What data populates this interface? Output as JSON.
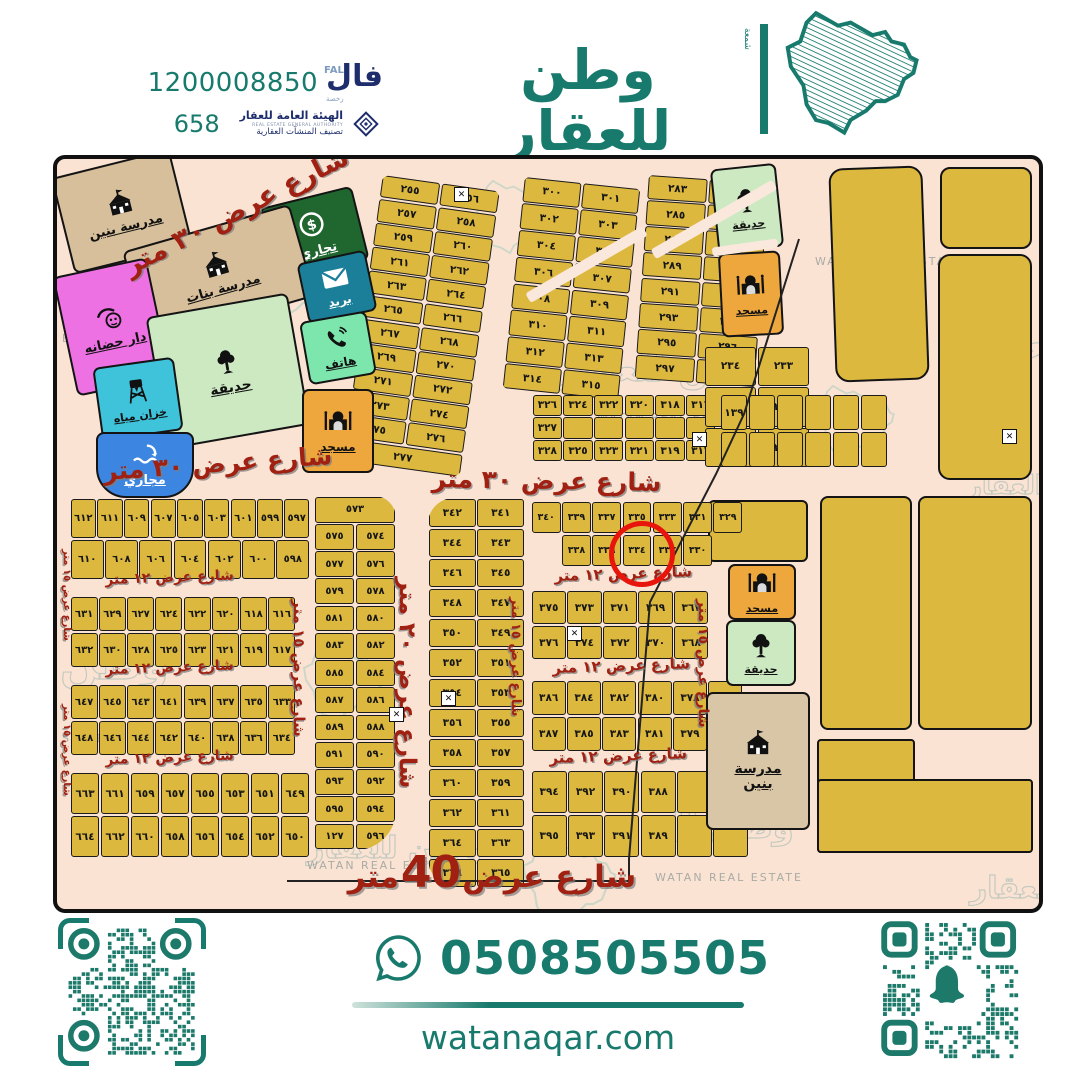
{
  "header": {
    "phone": "1200008850",
    "license": "658",
    "fal": {
      "ar": "فال",
      "en": "FAL",
      "sub": "رخصة"
    },
    "authority": {
      "name": "الهيئة العامة للعقار",
      "sub_en": "REAL ESTATE GENERAL AUTHORITY",
      "sub": "تصنيف المنشآت العقارية"
    },
    "brand": {
      "ar": "وطن للعقار",
      "en": "WATAN REAL ESTATE",
      "side": "شمعة"
    }
  },
  "footer": {
    "whatsapp": "0508505505",
    "website": "watanaqar.com"
  },
  "map": {
    "highlight": {
      "plot": "٣٣٤",
      "plot_latin": "334"
    },
    "facilities": {
      "school_boys": {
        "label": "مدرسة بنين"
      },
      "school_girls": {
        "label": "مدرسة بنات"
      },
      "commercial": {
        "label": "تجاري"
      },
      "post": {
        "label": "بريد"
      },
      "telephone": {
        "label": "هاتف"
      },
      "nursery": {
        "label": "دار حضانه"
      },
      "garden": {
        "label": "حديقة"
      },
      "water_tank": {
        "label": "خزان مياه"
      },
      "sewage": {
        "label": "مجاري"
      },
      "mosque": {
        "label": "مسجد"
      }
    },
    "street_labels": [
      {
        "text": "شارع عرض ٣٠ متر"
      },
      {
        "text": "شارع عرض ٣٠ متر"
      },
      {
        "text": "شارع عرض ٣٠ متر"
      },
      {
        "text": "شارع عرض ١٢ متر"
      },
      {
        "text": "شارع عرض ١٢ متر"
      },
      {
        "text": "شارع عرض ١٢ متر"
      },
      {
        "text": "شارع عرض ١٢ متر"
      },
      {
        "text": "شارع عرض ١٢ متر"
      },
      {
        "text": "شارع عرض ١٢ متر"
      },
      {
        "text": "شارع عرض ١٥ متر"
      },
      {
        "text": "شارع عرض ٢٠ متر"
      },
      {
        "text": "شارع عرض ١٥ متر"
      },
      {
        "text": "شارع عرض ١٥ متر"
      },
      {
        "text": "شارع عرض ١٥ متر"
      },
      {
        "text": "شارع عرض ١٥ متر"
      }
    ],
    "bottom_street": {
      "pre": "شارع عرض",
      "num": "40",
      "post": "متر"
    },
    "watermarks": [
      {
        "text": "وطن"
      },
      {
        "text": "طن للعقار"
      },
      {
        "text": "للعقار"
      },
      {
        "text": "العقار"
      },
      {
        "text": "وطن"
      },
      {
        "text": "لعقار"
      },
      {
        "text": "وطن لل"
      },
      {
        "text": "وطن للعقار"
      }
    ],
    "watermarks_en": [
      {
        "text": "WATAN REAL ESTATE"
      },
      {
        "text": "WATAN REAL ESTATE"
      },
      {
        "text": "ESTATE"
      },
      {
        "text": "STATE"
      },
      {
        "text": "WATAN REAL ESTATE"
      },
      {
        "text": "WATAN REAL ESTATE"
      }
    ],
    "blocks": [
      {
        "name": "b255",
        "rows": [
          [
            "٢٥٥",
            "٢٥٦"
          ],
          [
            "٢٥٧",
            "٢٥٨"
          ],
          [
            "٢٥٩",
            "٢٦٠"
          ],
          [
            "٢٦١",
            "٢٦٢"
          ],
          [
            "٢٦٣",
            "٢٦٤"
          ],
          [
            "٢٦٥",
            "٢٦٦"
          ],
          [
            "٢٦٧",
            "٢٦٨"
          ],
          [
            "٢٦٩",
            "٢٧٠"
          ],
          [
            "٢٧١",
            "٢٧٢"
          ],
          [
            "٢٧٣",
            "٢٧٤"
          ],
          [
            "٢٧٥",
            "٢٧٦"
          ],
          [
            "٢٧٧"
          ]
        ]
      },
      {
        "name": "b300",
        "rows": [
          [
            "٣٠٠",
            "٣٠١"
          ],
          [
            "٣٠٢",
            "٣٠٣"
          ],
          [
            "٣٠٤",
            "٣٠٥"
          ],
          [
            "٣٠٦",
            "٣٠٧"
          ],
          [
            "٣٠٨",
            "٣٠٩"
          ],
          [
            "٣١٠",
            "٣١١"
          ],
          [
            "٣١٢",
            "٣١٣"
          ],
          [
            "٣١٤",
            "٣١٥"
          ]
        ]
      },
      {
        "name": "b283",
        "rows": [
          [
            "٢٨٣",
            "٢٨٤"
          ],
          [
            "٢٨٥",
            "٢٨٦"
          ],
          [
            "٢٨٧",
            "٢٨٨"
          ],
          [
            "٢٨٩",
            "٢٩٠"
          ],
          [
            "٢٩١",
            "٢٩٢"
          ],
          [
            "٢٩٣",
            "٢٩٤"
          ],
          [
            "٢٩٥",
            "٢٩٦"
          ],
          [
            "٢٩٧",
            "٢٩٨"
          ]
        ]
      },
      {
        "name": "b316",
        "rows": [
          [
            "٣٢٦",
            "٣٢٤",
            "٣٢٢",
            "٣٢٠",
            "٣١٨",
            "٣١٦"
          ],
          [
            "٣٢٧",
            "",
            "",
            "",
            "",
            ""
          ],
          [
            "٣٢٨",
            "٣٢٥",
            "٣٢٣",
            "٣٢١",
            "٣١٩",
            "٣١٧"
          ]
        ]
      },
      {
        "name": "b233",
        "rows": [
          [
            "٢٣٤",
            "٢٣٣"
          ],
          [
            "٢٣٦",
            "٢٣٥"
          ],
          [
            "٢٣٨",
            "٢٣٧"
          ]
        ]
      },
      {
        "name": "b139",
        "rows": [
          [
            "١٣٩",
            "",
            "",
            "",
            "",
            ""
          ],
          [
            "",
            "",
            "",
            "",
            "",
            ""
          ]
        ]
      },
      {
        "name": "b597",
        "rows": [
          [
            "٦١٢",
            "٦١١",
            "٦٠٩",
            "٦٠٧",
            "٦٠٥",
            "٦٠٣",
            "٦٠١",
            "٥٩٩",
            "٥٩٧"
          ],
          [
            "٦١٠",
            "٦٠٨",
            "٦٠٦",
            "٦٠٤",
            "٦٠٢",
            "٦٠٠",
            "٥٩٨"
          ]
        ]
      },
      {
        "name": "b616",
        "rows": [
          [
            "٦٣١",
            "٦٢٩",
            "٦٢٧",
            "٦٢٤",
            "٦٢٢",
            "٦٢٠",
            "٦١٨",
            "٦١٦"
          ],
          [
            "٦٣٢",
            "٦٣٠",
            "٦٢٨",
            "٦٢٥",
            "٦٢٣",
            "٦٢١",
            "٦١٩",
            "٦١٧"
          ]
        ]
      },
      {
        "name": "b633",
        "rows": [
          [
            "٦٤٧",
            "٦٤٥",
            "٦٤٣",
            "٦٤١",
            "٦٣٩",
            "٦٣٧",
            "٦٣٥",
            "٦٣٣"
          ],
          [
            "٦٤٨",
            "٦٤٦",
            "٦٤٤",
            "٦٤٢",
            "٦٤٠",
            "٦٣٨",
            "٦٣٦",
            "٦٣٤"
          ]
        ]
      },
      {
        "name": "b649",
        "rows": [
          [
            "٦٦٣",
            "٦٦١",
            "٦٥٩",
            "٦٥٧",
            "٦٥٥",
            "٦٥٣",
            "٦٥١",
            "٦٤٩"
          ],
          [
            "٦٦٤",
            "٦٦٢",
            "٦٦٠",
            "٦٥٨",
            "٦٥٦",
            "٦٥٤",
            "٦٥٢",
            "٦٥٠"
          ]
        ]
      },
      {
        "name": "b573",
        "rows": [
          [
            "٥٧٣"
          ],
          [
            "٥٧٥",
            "٥٧٤"
          ],
          [
            "٥٧٧",
            "٥٧٦"
          ],
          [
            "٥٧٩",
            "٥٧٨"
          ],
          [
            "٥٨١",
            "٥٨٠"
          ],
          [
            "٥٨٣",
            "٥٨٢"
          ],
          [
            "٥٨٥",
            "٥٨٤"
          ],
          [
            "٥٨٧",
            "٥٨٦"
          ],
          [
            "٥٨٩",
            "٥٨٨"
          ],
          [
            "٥٩١",
            "٥٩٠"
          ],
          [
            "٥٩٣",
            "٥٩٢"
          ],
          [
            "٥٩٥",
            "٥٩٤"
          ],
          [
            "١٢٧",
            "٥٩٦"
          ]
        ]
      },
      {
        "name": "b341",
        "rows": [
          [
            "٣٤٢",
            "٣٤١"
          ],
          [
            "٣٤٤",
            "٣٤٣"
          ],
          [
            "٣٤٦",
            "٣٤٥"
          ],
          [
            "٣٤٨",
            "٣٤٧"
          ],
          [
            "٣٥٠",
            "٣٤٩"
          ],
          [
            "٣٥٢",
            "٣٥١"
          ],
          [
            "٣٥٤",
            "٣٥٣"
          ],
          [
            "٣٥٦",
            "٣٥٥"
          ],
          [
            "٣٥٨",
            "٣٥٧"
          ],
          [
            "٣٦٠",
            "٣٥٩"
          ],
          [
            "٣٦٢",
            "٣٦١"
          ],
          [
            "٣٦٤",
            "٣٦٣"
          ],
          [
            "٣٦٦",
            "٣٦٥"
          ]
        ]
      },
      {
        "name": "b329",
        "rows": [
          [
            "٣٤٠",
            "٣٣٩",
            "٣٣٧",
            "٣٣٥",
            "٣٣٣",
            "٣٣١",
            "٣٢٩"
          ],
          [
            null,
            "٣٣٨",
            "٣٣٦",
            "٣٣٤",
            "٣٣٢",
            "٣٣٠",
            null
          ]
        ]
      },
      {
        "name": "b367",
        "rows": [
          [
            "٣٧٥",
            "٣٧٣",
            "٣٧١",
            "٣٦٩",
            "٣٦٧"
          ],
          [
            "٣٧٦",
            "٣٧٤",
            "٣٧٢",
            "٣٧٠",
            "٣٦٨"
          ]
        ]
      },
      {
        "name": "b378",
        "rows": [
          [
            "٣٨٦",
            "٣٨٤",
            "٣٨٢",
            "٣٨٠",
            "٣٧٨",
            ""
          ],
          [
            "٣٨٧",
            "٣٨٥",
            "٣٨٣",
            "٣٨١",
            "٣٧٩",
            ""
          ]
        ]
      },
      {
        "name": "b388",
        "rows": [
          [
            "٣٩٤",
            "٣٩٢",
            "٣٩٠",
            "٣٨٨",
            "",
            ""
          ],
          [
            "٣٩٥",
            "٣٩٣",
            "٣٩١",
            "٣٨٩",
            "",
            ""
          ]
        ]
      }
    ]
  },
  "colors": {
    "brand": "#177a6c",
    "navy": "#1e2d6b",
    "map_bg": "#fbe3d4",
    "plot": "#dcb83e",
    "street_red": "#a02112",
    "highlight": "#e8150c",
    "mosque": "#eda73d",
    "garden": "#cde9c2",
    "school": "#d8bf9b",
    "commercial": "#20662f",
    "post": "#1c7f99",
    "telephone": "#7de6ad",
    "nursery": "#ee71e4",
    "water_tank": "#3fc3da",
    "sewage": "#3c85e0"
  }
}
